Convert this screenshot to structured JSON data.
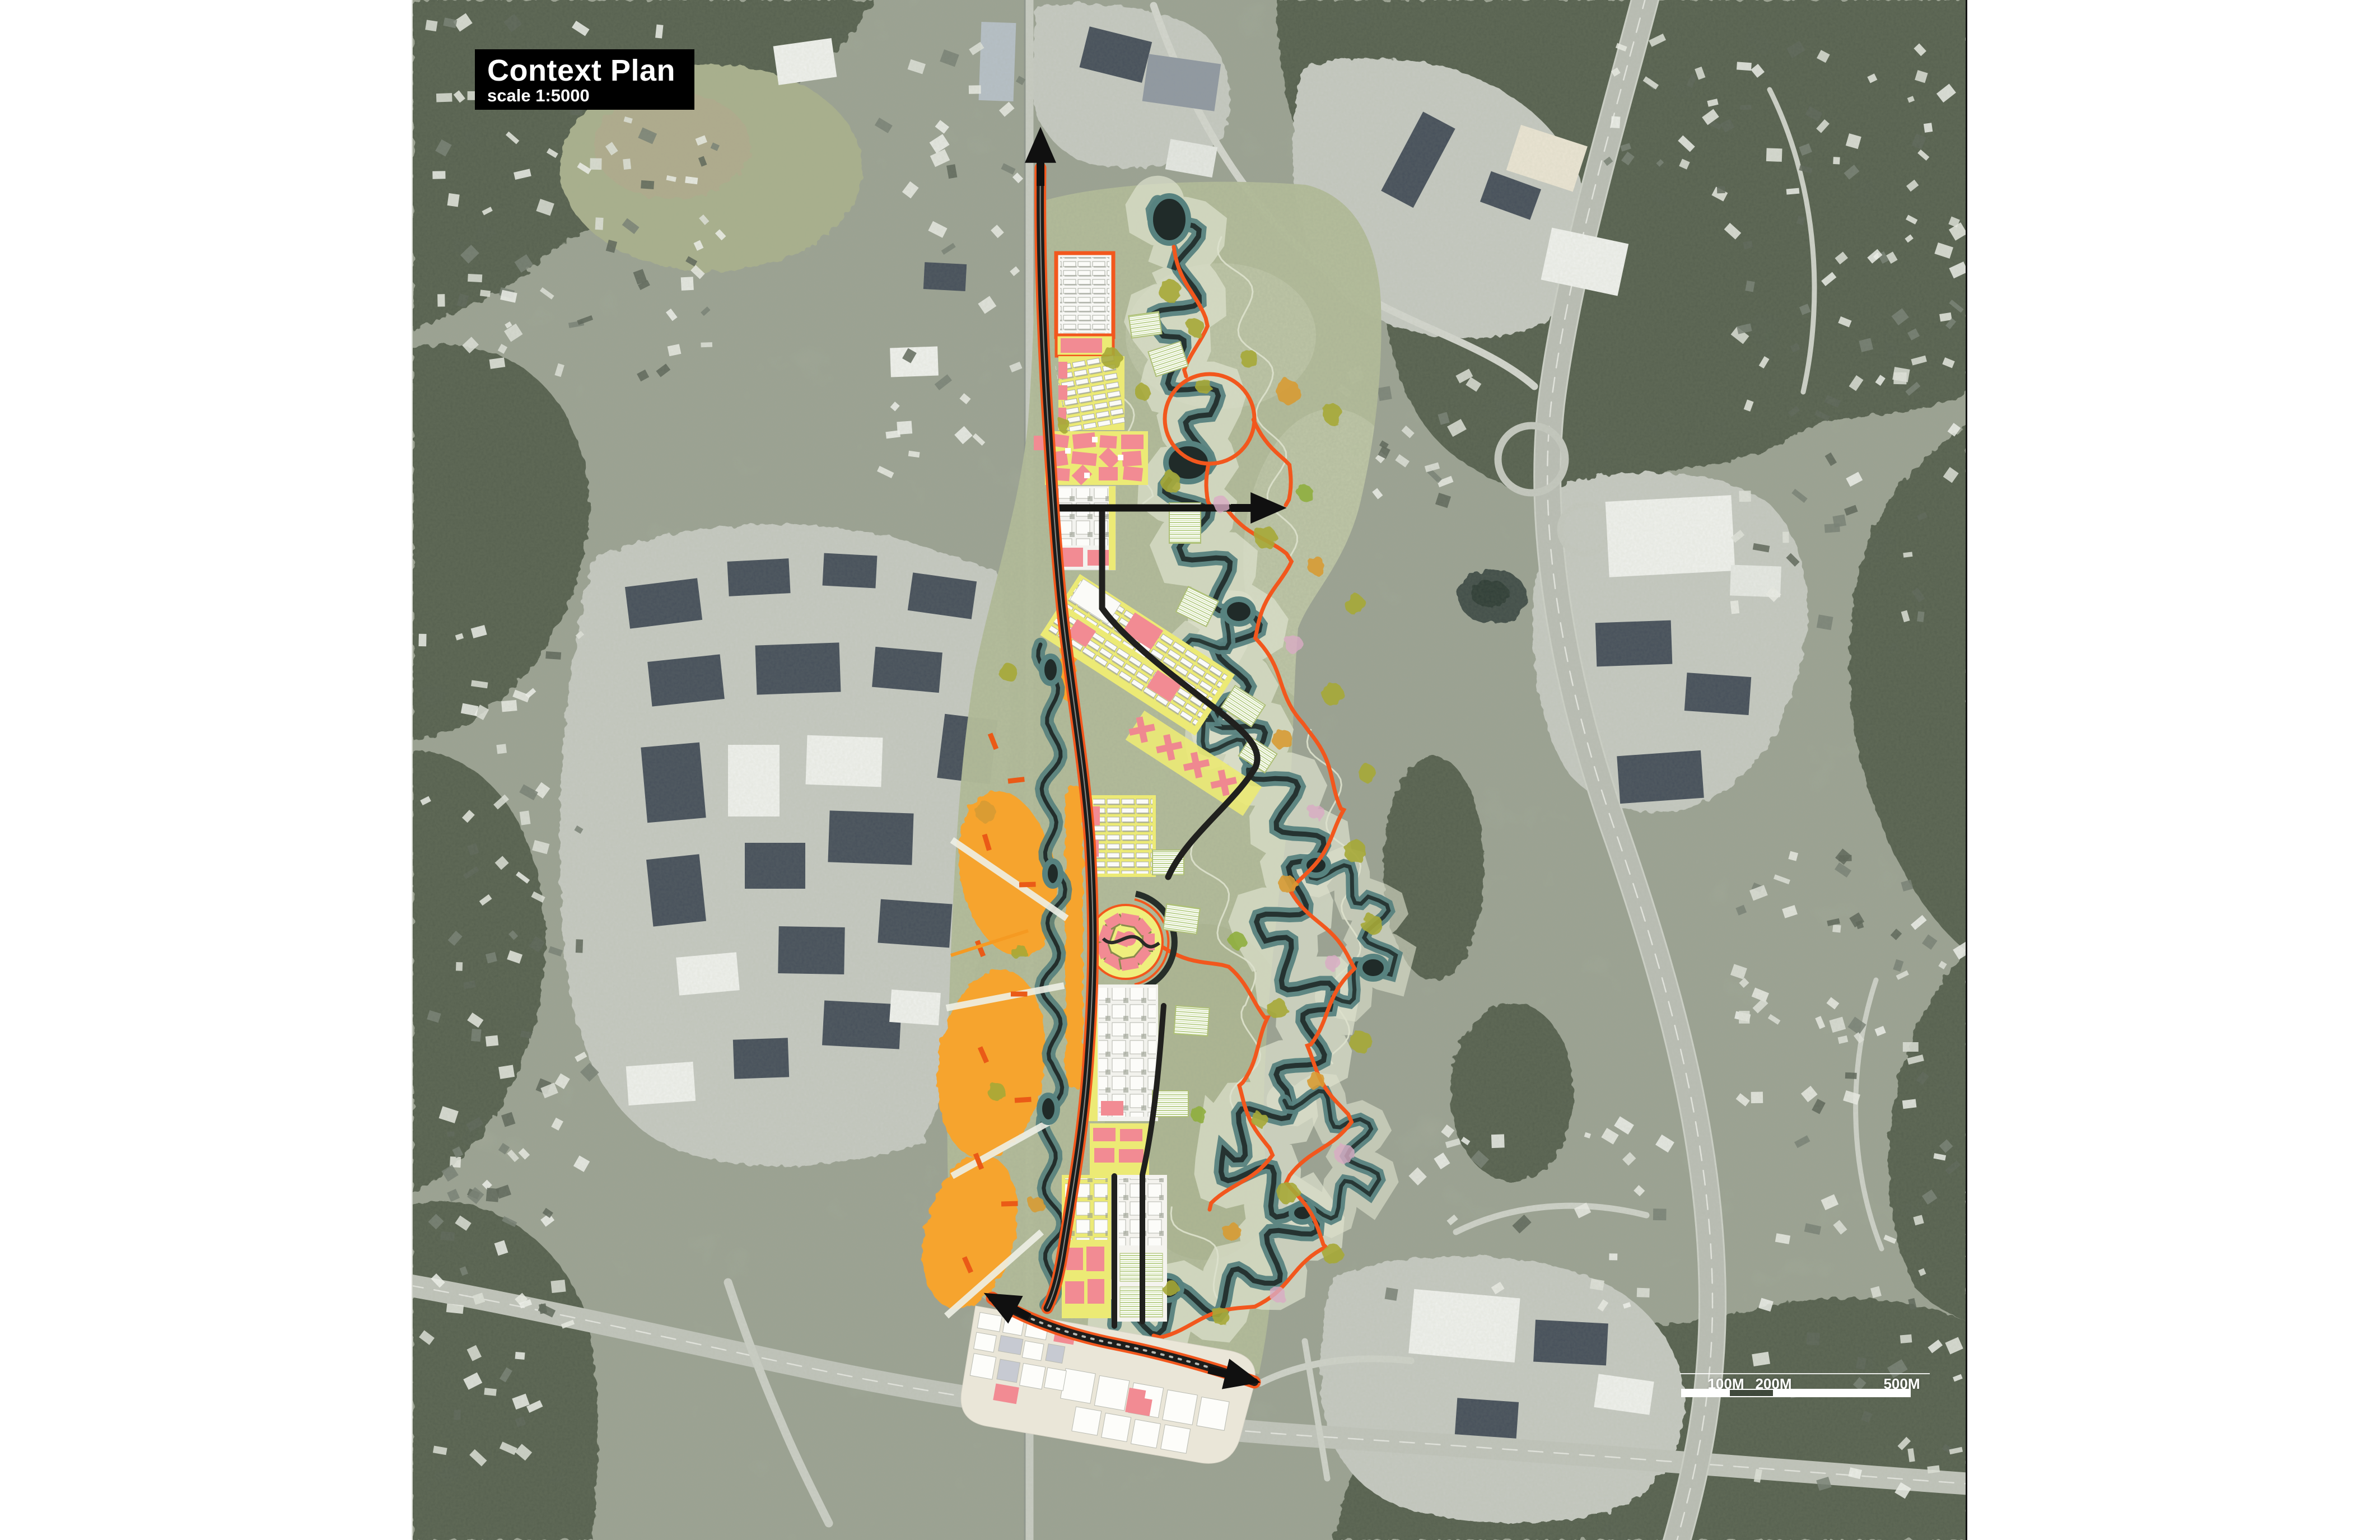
{
  "title_block": {
    "title": "Context Plan",
    "scale_label": "scale 1:5000"
  },
  "scale_bar": {
    "labels": [
      "100M",
      "200M",
      "500M"
    ],
    "ticks_meters": [
      100,
      200,
      500
    ]
  },
  "icons": {
    "north-arrow": "up-arrow",
    "access-arrow-east": "right-arrow",
    "access-arrow-southwest": "diagonal-arrow",
    "access-arrow-southeast": "diagonal-arrow"
  },
  "palette": {
    "title_bg": "#000000",
    "title_text": "#ffffff",
    "masterplan_yellow": "#ecea75",
    "masterplan_pink": "#f28b93",
    "masterplan_orange_line": "#f2571d",
    "wetland_amber": "#f6a42d",
    "river_teal": "#57827f",
    "river_dark": "#1f2a28",
    "park_green": "#b7bf9b",
    "road_black": "#1d1d1b",
    "aerial_forest": "#4d5846",
    "aerial_urban": "#c7cac3",
    "scale_bar_white": "#ffffff"
  }
}
